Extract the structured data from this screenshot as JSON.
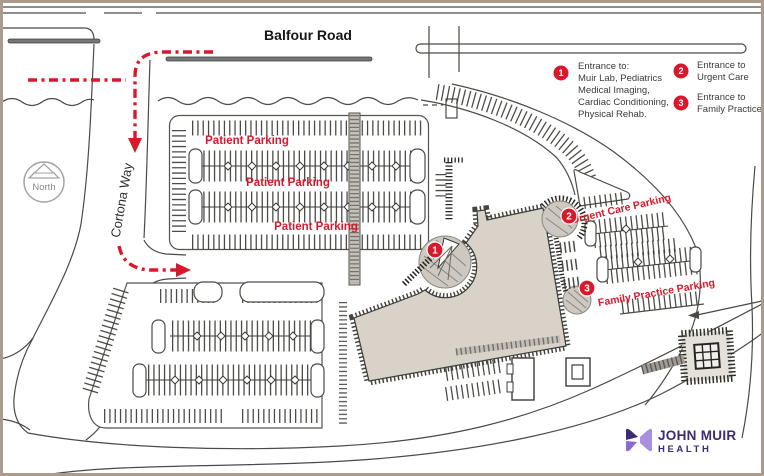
{
  "map": {
    "street_top": "Balfour Road",
    "street_left": "Cortona Way",
    "compass": "North",
    "labels": {
      "patient": "Patient Parking",
      "urgent": "Urgent Care Parking",
      "family": "Family Practice Parking"
    },
    "markers": {
      "m1": "1",
      "m2": "2",
      "m3": "3"
    }
  },
  "legend": {
    "items": [
      {
        "number": "1",
        "lines": [
          "Entrance to:",
          "Muir Lab, Pediatrics",
          "Medical Imaging,",
          "Cardiac Conditioning,",
          "Physical Rehab."
        ]
      },
      {
        "number": "2",
        "lines": [
          "Entrance to",
          "Urgent Care"
        ]
      },
      {
        "number": "3",
        "lines": [
          "Entrance to",
          "Family Practice"
        ]
      }
    ]
  },
  "logo": {
    "title": "JOHN MUIR",
    "subtitle": "HEALTH"
  },
  "colors": {
    "accent_red": "#d8192c",
    "building_fill": "#d8d2c8",
    "frame_border": "#ac9b8b",
    "logo_dark": "#3b2a74",
    "logo_light": "#a98fe2"
  }
}
